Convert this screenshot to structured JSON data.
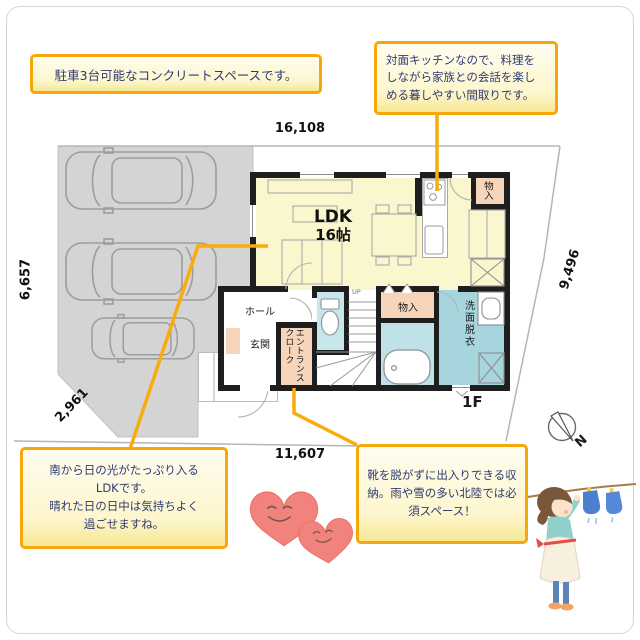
{
  "callouts": {
    "parking": {
      "lines": [
        "駐車3台可能なコンクリートスペースです。"
      ]
    },
    "kitchen": {
      "lines": [
        "対面キッチンなので、料理を",
        "しながら家族との会話を楽し",
        "める暮しやすい間取りです。"
      ]
    },
    "ldk": {
      "lines": [
        "南から日の光がたっぷり入る",
        "LDKです。",
        "晴れた日の日中は気持ちよく",
        "過ごせますね。"
      ]
    },
    "cloak": {
      "lines": [
        "靴を脱がずに出入りできる収",
        "納。雨や雪の多い北陸では必",
        "須スペース！"
      ]
    }
  },
  "dimensions": {
    "top": "16,108",
    "left": "6,657",
    "right": "9,496",
    "bottom_left": "2,961",
    "bottom": "11,607"
  },
  "plan": {
    "floor_label": "1F",
    "rooms": {
      "ldk_name": "LDK",
      "ldk_size": "16帖",
      "hall": "ホール",
      "genkan": "玄関",
      "entrance_cloak": "エントランスクローク",
      "closet_top": "物入",
      "closet_mid": "物入",
      "washroom": "洗面脱衣",
      "stairs": "UP"
    }
  },
  "compass": {
    "north": "N"
  },
  "colors": {
    "annotation_line": "#f9ac0b",
    "callout_border": "#f6a70a",
    "callout_bg": "#fdf6cd",
    "callout_text": "#2e3a70",
    "floor_ldk": "#faf7ce",
    "room_salmon": "#f6d5bb",
    "room_blue": "#c6e6ec",
    "room_teal": "#a7d5dd",
    "wall": "#1e1e1e",
    "site_gray": "#d4d4d4",
    "heart_color": "#f2837c",
    "sock_color": "#4d7fd0"
  }
}
